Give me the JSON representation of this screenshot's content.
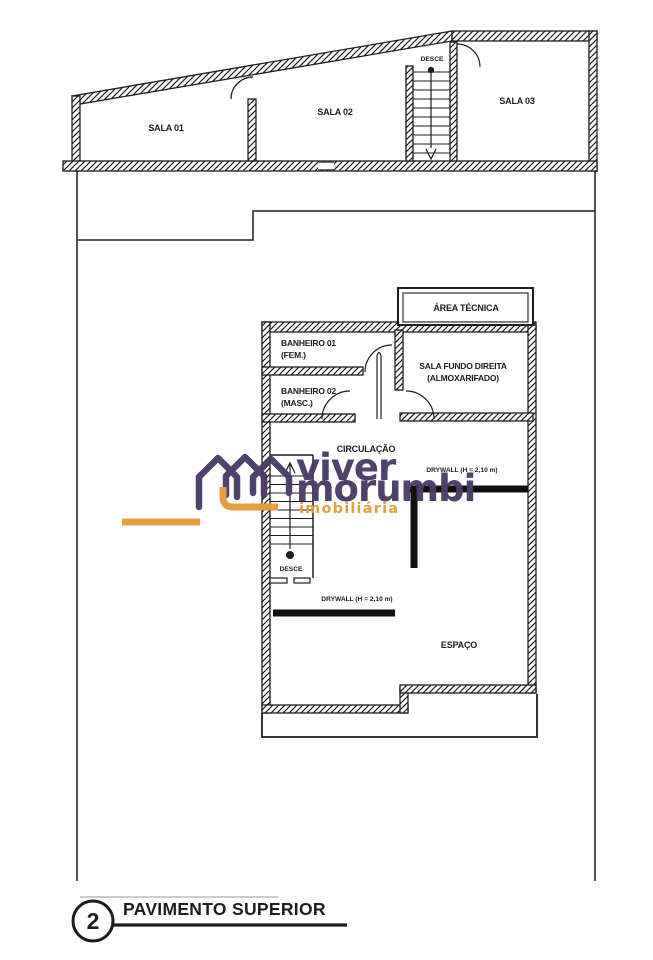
{
  "plan": {
    "rooms": {
      "sala01": "SALA 01",
      "sala02": "SALA 02",
      "sala03": "SALA 03",
      "area_tecnica": "ÁREA TÉCNICA",
      "banheiro01_l1": "BANHEIRO 01",
      "banheiro01_l2": "(FEM.)",
      "banheiro02_l1": "BANHEIRO 02",
      "banheiro02_l2": "(MASC.)",
      "sala_fundo_l1": "SALA FUNDO DIREITA",
      "sala_fundo_l2": "(ALMOXARIFADO)",
      "circulacao": "CIRCULAÇÃO",
      "espaco": "ESPAÇO"
    },
    "stairs": {
      "desce_top": "DESCE",
      "desce_mid": "DESCE"
    },
    "annotations": {
      "drywall_upper": "DRYWALL (H = 2,10 m)",
      "drywall_lower": "DRYWALL (H = 2,10 m)"
    },
    "title": {
      "number": "2",
      "label": "PAVIMENTO SUPERIOR"
    },
    "ink_color": "#1d1d1d"
  },
  "watermark": {
    "line1": "viver",
    "line2": "morumbi",
    "line3": "imobiliária",
    "purple": "#4a3c67",
    "orange": "#e79b3a"
  }
}
